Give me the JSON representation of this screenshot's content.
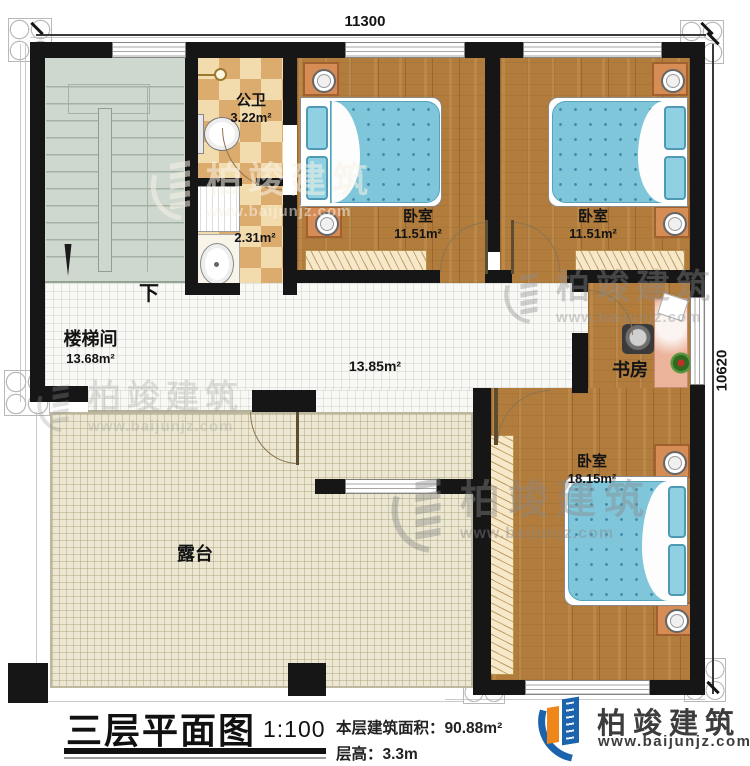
{
  "plan": {
    "dimensions": {
      "top": "11300",
      "right": "10620"
    },
    "rooms": {
      "stairwell": {
        "name": "楼梯间",
        "area": "13.68m²",
        "direction_label": "下"
      },
      "bathroom": {
        "name": "公卫",
        "area": "3.22m²",
        "sub_area": "2.31m²"
      },
      "bedroom_top_left": {
        "name": "卧室",
        "area": "11.51m²"
      },
      "bedroom_top_right": {
        "name": "卧室",
        "area": "11.51m²"
      },
      "bedroom_bottom": {
        "name": "卧室",
        "area": "18.15m²"
      },
      "study": {
        "name": "书房"
      },
      "hallway": {
        "area": "13.85m²"
      },
      "terrace": {
        "name": "露台"
      }
    }
  },
  "title_block": {
    "title": "三层平面图",
    "scale": "1:100",
    "area_line": "本层建筑面积：90.88m²",
    "floor_height_line": "层高：3.3m"
  },
  "brand": {
    "name": "柏竣建筑",
    "website": "www.baijunjz.com"
  },
  "watermark": {
    "name": "柏竣建筑",
    "website": "www.baijunjz.com"
  },
  "colors": {
    "wall": "#161616",
    "wood_floor": "#b27c3c",
    "tile_checker_light": "#f2dcae",
    "tile_checker_dark": "#dcab6e",
    "stair_floor": "#cfd8ce",
    "terrace_floor": "#ebe7d2",
    "hallway_floor": "#f8f8f4",
    "bed_blue": "#7fc6da",
    "nightstand_orange": "#d58c55",
    "desk_pink": "#edb49c",
    "logo_blue": "#1b63ad",
    "logo_orange": "#f08519"
  }
}
